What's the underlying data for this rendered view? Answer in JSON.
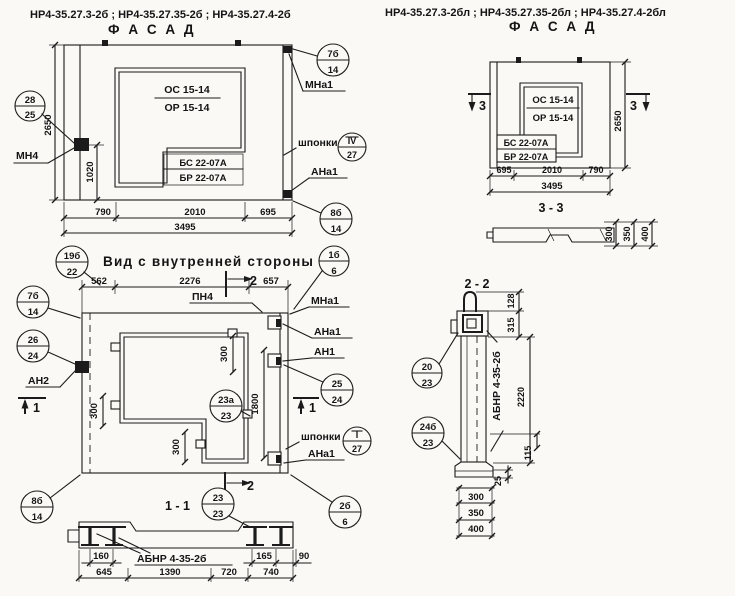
{
  "header": {
    "left_codes": "НР4-35.27.3-2б ;  НР4-35.27.35-2б ;  НР4-35.27.4-2б",
    "left_title": "Ф А С А Д",
    "right_codes": "НР4-35.27.3-2бл ;  НР4-35.27.35-2бл ;  НР4-35.27.4-2бл",
    "right_title": "Ф А С А Д"
  },
  "facade": {
    "osc": "ОС 15-14",
    "orr": "ОР 15-14",
    "bs": "БС 22-07А",
    "br": "БР 22-07А",
    "d2650": "2650",
    "d1020": "1020",
    "d790": "790",
    "d2010": "2010",
    "d695": "695",
    "d3495": "3495",
    "mn4": "МН4",
    "mna1": "МНа1",
    "shponki": "шпонки",
    "ana1": "АНа1",
    "c28": {
      "num": "28",
      "den": "25"
    },
    "c7b": {
      "num": "7б",
      "den": "14"
    },
    "c4": {
      "num": "IV",
      "den": "27"
    },
    "c8b": {
      "num": "8б",
      "den": "14"
    }
  },
  "inner": {
    "title": "Вид с внутренней стороны",
    "c19b": {
      "num": "19б",
      "den": "22"
    },
    "d562": "562",
    "d2276": "2276",
    "d657": "657",
    "pn4": "ПН4",
    "m2": "2",
    "m1": "1",
    "c7b": {
      "num": "7б",
      "den": "14"
    },
    "c26": {
      "num": "26",
      "den": "24"
    },
    "an2": "АН2",
    "mna1": "МНа1",
    "ana1a": "АНа1",
    "an1": "АН1",
    "c25": {
      "num": "25",
      "den": "24"
    },
    "c1b": {
      "num": "1б",
      "den": "6"
    },
    "shponki": "шпонки",
    "cI": {
      "num": "I",
      "den": "27"
    },
    "ana1b": "АНа1",
    "c2b": {
      "num": "2б",
      "den": "6"
    },
    "c8b": {
      "num": "8б",
      "den": "14"
    },
    "c23a": {
      "num": "23а",
      "den": "23"
    },
    "d300": "300",
    "d1800": "1800"
  },
  "section11": {
    "title": "1 - 1",
    "c23": {
      "num": "23",
      "den": "23"
    },
    "abnr": "АБНР 4-35-2б",
    "d160": "160",
    "d165": "165",
    "d90": "90",
    "d645": "645",
    "d1390": "1390",
    "d720": "720",
    "d740": "740"
  },
  "facadeR": {
    "osc": "ОС 15-14",
    "orr": "ОР 15-14",
    "bs": "БС 22-07А",
    "br": "БР 22-07А",
    "d2650": "2650",
    "d695": "695",
    "d2010": "2010",
    "d790": "790",
    "d3495": "3495",
    "m3": "3",
    "title33": "3 - 3"
  },
  "section33": {
    "d300": "300",
    "d350": "350",
    "d400": "400"
  },
  "section22": {
    "title": "2 - 2",
    "c20": {
      "num": "20",
      "den": "23"
    },
    "c24b": {
      "num": "24б",
      "den": "23"
    },
    "abnr": "АБНР 4-35-2б",
    "d128": "128",
    "d315": "315",
    "d2220": "2220",
    "d115": "115",
    "d25": "25",
    "d300": "300",
    "d350": "350",
    "d400": "400"
  }
}
